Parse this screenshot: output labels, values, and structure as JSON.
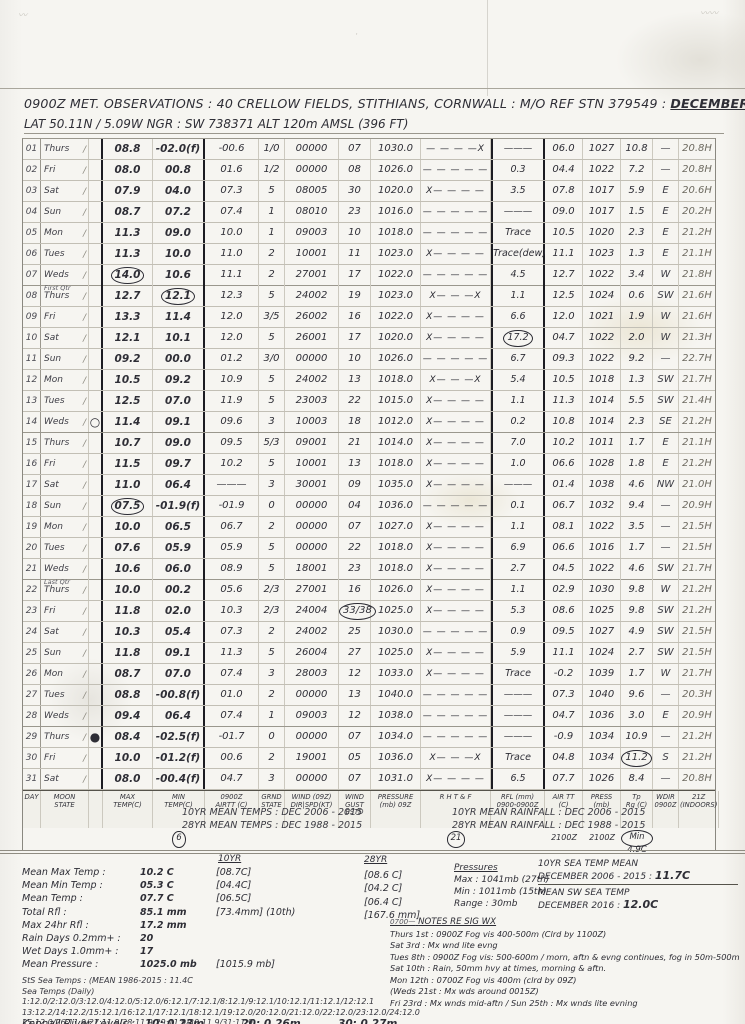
{
  "header": {
    "title_main": "0900Z  MET. OBSERVATIONS :  40 CRELLOW FIELDS, STITHIANS, CORNWALL :  M/O REF STN 379549 :",
    "title_period": "DECEMBER 2016",
    "subtitle": "LAT 50.11N / 5.09W    NGR : SW 738371    ALT 120m AMSL  (396 FT)"
  },
  "table": {
    "order": [
      "d",
      "wk",
      "moon",
      "mx",
      "mn",
      "a9",
      "g",
      "w",
      "gu",
      "p9",
      "rh",
      "rf",
      "a21",
      "p21",
      "tr",
      "wd",
      "ind"
    ],
    "footer_labels": {
      "d": "DAY",
      "wk": "MOON\nSTATE",
      "moon": "",
      "mx": "MAX\nTEMP(C)",
      "mn": "MIN\nTEMP(C)",
      "a9": "0900Z\nAIRTT (C)",
      "g": "GRND\nSTATE",
      "w": "WIND (09Z)\nDIR|SPD(KT)",
      "gu": "WIND\nGUST\nESTD",
      "p9": "PRESSURE\n(mb) 09Z",
      "rh": "R H T & F",
      "rf": "RFL (mm)\n0900-0900Z",
      "a21": "AIR TT\n(C)",
      "p21": "PRESS\n(mb)",
      "tr": "Tp\nRg (C)",
      "wd": "WDIR\n0900Z",
      "ind": "21Z\n(INDOORS)"
    },
    "footer_sub": {
      "mn": "6",
      "rh": "21",
      "a21": "2100Z",
      "p21": "2100Z",
      "tr": "Min 4.9C"
    },
    "rows": [
      {
        "d": "01",
        "wk": "Thurs",
        "note": "",
        "moon": "",
        "mx": "08.8",
        "mn": "-02.0(f)",
        "a9": "-00.6",
        "g": "1/0",
        "w": "00000",
        "gu": "07",
        "p9": "1030.0",
        "rh": "— — — —X",
        "rf": "———",
        "a21": "06.0",
        "p21": "1027",
        "tr": "10.8",
        "wd": "—",
        "ind": "20.8H",
        "circled": []
      },
      {
        "d": "02",
        "wk": "Fri",
        "note": "",
        "moon": "",
        "mx": "08.0",
        "mn": "00.8",
        "a9": "01.6",
        "g": "1/2",
        "w": "00000",
        "gu": "08",
        "p9": "1026.0",
        "rh": "— — — — —",
        "rf": "0.3",
        "a21": "04.4",
        "p21": "1022",
        "tr": "7.2",
        "wd": "—",
        "ind": "20.8H",
        "circled": []
      },
      {
        "d": "03",
        "wk": "Sat",
        "note": "",
        "moon": "",
        "mx": "07.9",
        "mn": "04.0",
        "a9": "07.3",
        "g": "5",
        "w": "08005",
        "gu": "30",
        "p9": "1020.0",
        "rh": "X— — — —",
        "rf": "3.5",
        "a21": "07.8",
        "p21": "1017",
        "tr": "5.9",
        "wd": "E",
        "ind": "20.6H",
        "circled": []
      },
      {
        "d": "04",
        "wk": "Sun",
        "note": "",
        "moon": "",
        "mx": "08.7",
        "mn": "07.2",
        "a9": "07.4",
        "g": "1",
        "w": "08010",
        "gu": "23",
        "p9": "1016.0",
        "rh": "— — — — —",
        "rf": "———",
        "a21": "09.0",
        "p21": "1017",
        "tr": "1.5",
        "wd": "E",
        "ind": "20.2H",
        "circled": []
      },
      {
        "d": "05",
        "wk": "Mon",
        "note": "",
        "moon": "",
        "mx": "11.3",
        "mn": "09.0",
        "a9": "10.0",
        "g": "1",
        "w": "09003",
        "gu": "10",
        "p9": "1018.0",
        "rh": "— — — — —",
        "rf": "Trace",
        "a21": "10.5",
        "p21": "1020",
        "tr": "2.3",
        "wd": "E",
        "ind": "21.2H",
        "circled": []
      },
      {
        "d": "06",
        "wk": "Tues",
        "note": "",
        "moon": "",
        "mx": "11.3",
        "mn": "10.0",
        "a9": "11.0",
        "g": "2",
        "w": "10001",
        "gu": "11",
        "p9": "1023.0",
        "rh": "X— — — —",
        "rf": "Trace(dew)",
        "a21": "11.1",
        "p21": "1023",
        "tr": "1.3",
        "wd": "E",
        "ind": "21.1H",
        "circled": []
      },
      {
        "d": "07",
        "wk": "Weds",
        "note": "First Qtr",
        "moon": "",
        "mx": "14.0",
        "mn": "10.6",
        "a9": "11.1",
        "g": "2",
        "w": "27001",
        "gu": "17",
        "p9": "1022.0",
        "rh": "— — — — —",
        "rf": "4.5",
        "a21": "12.7",
        "p21": "1022",
        "tr": "3.4",
        "wd": "W",
        "ind": "21.8H",
        "circled": [
          "mx"
        ]
      },
      {
        "d": "08",
        "wk": "Thurs",
        "note": "",
        "moon": "",
        "mx": "12.7",
        "mn": "12.1",
        "a9": "12.3",
        "g": "5",
        "w": "24002",
        "gu": "19",
        "p9": "1023.0",
        "rh": "X— — —X",
        "rf": "1.1",
        "a21": "12.5",
        "p21": "1024",
        "tr": "0.6",
        "wd": "SW",
        "ind": "21.6H",
        "circled": [
          "mn"
        ]
      },
      {
        "d": "09",
        "wk": "Fri",
        "note": "",
        "moon": "",
        "mx": "13.3",
        "mn": "11.4",
        "a9": "12.0",
        "g": "3/5",
        "w": "26002",
        "gu": "16",
        "p9": "1022.0",
        "rh": "X— — — —",
        "rf": "6.6",
        "a21": "12.0",
        "p21": "1021",
        "tr": "1.9",
        "wd": "W",
        "ind": "21.6H",
        "circled": []
      },
      {
        "d": "10",
        "wk": "Sat",
        "note": "",
        "moon": "",
        "mx": "12.1",
        "mn": "10.1",
        "a9": "12.0",
        "g": "5",
        "w": "26001",
        "gu": "17",
        "p9": "1020.0",
        "rh": "X— — — —",
        "rf": "17.2",
        "a21": "04.7",
        "p21": "1022",
        "tr": "2.0",
        "wd": "W",
        "ind": "21.3H",
        "circled": [
          "rf"
        ]
      },
      {
        "d": "11",
        "wk": "Sun",
        "note": "",
        "moon": "",
        "mx": "09.2",
        "mn": "00.0",
        "a9": "01.2",
        "g": "3/0",
        "w": "00000",
        "gu": "10",
        "p9": "1026.0",
        "rh": "— — — — —",
        "rf": "6.7",
        "a21": "09.3",
        "p21": "1022",
        "tr": "9.2",
        "wd": "—",
        "ind": "22.7H",
        "circled": []
      },
      {
        "d": "12",
        "wk": "Mon",
        "note": "",
        "moon": "",
        "mx": "10.5",
        "mn": "09.2",
        "a9": "10.9",
        "g": "5",
        "w": "24002",
        "gu": "13",
        "p9": "1018.0",
        "rh": "X— — —X",
        "rf": "5.4",
        "a21": "10.5",
        "p21": "1018",
        "tr": "1.3",
        "wd": "SW",
        "ind": "21.7H",
        "circled": []
      },
      {
        "d": "13",
        "wk": "Tues",
        "note": "",
        "moon": "",
        "mx": "12.5",
        "mn": "07.0",
        "a9": "11.9",
        "g": "5",
        "w": "23003",
        "gu": "22",
        "p9": "1015.0",
        "rh": "X— — — —",
        "rf": "1.1",
        "a21": "11.3",
        "p21": "1014",
        "tr": "5.5",
        "wd": "SW",
        "ind": "21.4H",
        "circled": []
      },
      {
        "d": "14",
        "wk": "Weds",
        "note": "",
        "moon": "○",
        "mx": "11.4",
        "mn": "09.1",
        "a9": "09.6",
        "g": "3",
        "w": "10003",
        "gu": "18",
        "p9": "1012.0",
        "rh": "X— — — —",
        "rf": "0.2",
        "a21": "10.8",
        "p21": "1014",
        "tr": "2.3",
        "wd": "SE",
        "ind": "21.2H",
        "circled": []
      },
      {
        "d": "15",
        "wk": "Thurs",
        "note": "",
        "moon": "",
        "mx": "10.7",
        "mn": "09.0",
        "a9": "09.5",
        "g": "5/3",
        "w": "09001",
        "gu": "21",
        "p9": "1014.0",
        "rh": "X— — — —",
        "rf": "7.0",
        "a21": "10.2",
        "p21": "1011",
        "tr": "1.7",
        "wd": "E",
        "ind": "21.1H",
        "circled": []
      },
      {
        "d": "16",
        "wk": "Fri",
        "note": "",
        "moon": "",
        "mx": "11.5",
        "mn": "09.7",
        "a9": "10.2",
        "g": "5",
        "w": "10001",
        "gu": "13",
        "p9": "1018.0",
        "rh": "X— — — —",
        "rf": "1.0",
        "a21": "06.6",
        "p21": "1028",
        "tr": "1.8",
        "wd": "E",
        "ind": "21.2H",
        "circled": []
      },
      {
        "d": "17",
        "wk": "Sat",
        "note": "",
        "moon": "",
        "mx": "11.0",
        "mn": "06.4",
        "a9": "———",
        "g": "3",
        "w": "30001",
        "gu": "09",
        "p9": "1035.0",
        "rh": "X— — — —",
        "rf": "———",
        "a21": "01.4",
        "p21": "1038",
        "tr": "4.6",
        "wd": "NW",
        "ind": "21.0H",
        "circled": []
      },
      {
        "d": "18",
        "wk": "Sun",
        "note": "",
        "moon": "",
        "mx": "07.5",
        "mn": "-01.9(f)",
        "a9": "-01.9",
        "g": "0",
        "w": "00000",
        "gu": "04",
        "p9": "1036.0",
        "rh": "— — — — —",
        "rf": "0.1",
        "a21": "06.7",
        "p21": "1032",
        "tr": "9.4",
        "wd": "—",
        "ind": "20.9H",
        "circled": [
          "mx"
        ]
      },
      {
        "d": "19",
        "wk": "Mon",
        "note": "",
        "moon": "",
        "mx": "10.0",
        "mn": "06.5",
        "a9": "06.7",
        "g": "2",
        "w": "00000",
        "gu": "07",
        "p9": "1027.0",
        "rh": "X— — — —",
        "rf": "1.1",
        "a21": "08.1",
        "p21": "1022",
        "tr": "3.5",
        "wd": "—",
        "ind": "21.5H",
        "circled": []
      },
      {
        "d": "20",
        "wk": "Tues",
        "note": "",
        "moon": "",
        "mx": "07.6",
        "mn": "05.9",
        "a9": "05.9",
        "g": "5",
        "w": "00000",
        "gu": "22",
        "p9": "1018.0",
        "rh": "X— — — —",
        "rf": "6.9",
        "a21": "06.6",
        "p21": "1016",
        "tr": "1.7",
        "wd": "—",
        "ind": "21.5H",
        "circled": []
      },
      {
        "d": "21",
        "wk": "Weds",
        "note": "Last Qtr",
        "moon": "",
        "mx": "10.6",
        "mn": "06.0",
        "a9": "08.9",
        "g": "5",
        "w": "18001",
        "gu": "23",
        "p9": "1018.0",
        "rh": "X— — — —",
        "rf": "2.7",
        "a21": "04.5",
        "p21": "1022",
        "tr": "4.6",
        "wd": "SW",
        "ind": "21.7H",
        "circled": []
      },
      {
        "d": "22",
        "wk": "Thurs",
        "note": "",
        "moon": "",
        "mx": "10.0",
        "mn": "00.2",
        "a9": "05.6",
        "g": "2/3",
        "w": "27001",
        "gu": "16",
        "p9": "1026.0",
        "rh": "X— — — —",
        "rf": "1.1",
        "a21": "02.9",
        "p21": "1030",
        "tr": "9.8",
        "wd": "W",
        "ind": "21.2H",
        "circled": []
      },
      {
        "d": "23",
        "wk": "Fri",
        "note": "",
        "moon": "",
        "mx": "11.8",
        "mn": "02.0",
        "a9": "10.3",
        "g": "2/3",
        "w": "24004",
        "gu": "33/38",
        "p9": "1025.0",
        "rh": "X— — — —",
        "rf": "5.3",
        "a21": "08.6",
        "p21": "1025",
        "tr": "9.8",
        "wd": "SW",
        "ind": "21.2H",
        "circled": [
          "gu"
        ]
      },
      {
        "d": "24",
        "wk": "Sat",
        "note": "",
        "moon": "",
        "mx": "10.3",
        "mn": "05.4",
        "a9": "07.3",
        "g": "2",
        "w": "24002",
        "gu": "25",
        "p9": "1030.0",
        "rh": "— — — — —",
        "rf": "0.9",
        "a21": "09.5",
        "p21": "1027",
        "tr": "4.9",
        "wd": "SW",
        "ind": "21.5H",
        "circled": []
      },
      {
        "d": "25",
        "wk": "Sun",
        "note": "",
        "moon": "",
        "mx": "11.8",
        "mn": "09.1",
        "a9": "11.3",
        "g": "5",
        "w": "26004",
        "gu": "27",
        "p9": "1025.0",
        "rh": "X— — — —",
        "rf": "5.9",
        "a21": "11.1",
        "p21": "1024",
        "tr": "2.7",
        "wd": "SW",
        "ind": "21.5H",
        "circled": []
      },
      {
        "d": "26",
        "wk": "Mon",
        "note": "",
        "moon": "",
        "mx": "08.7",
        "mn": "07.0",
        "a9": "07.4",
        "g": "3",
        "w": "28003",
        "gu": "12",
        "p9": "1033.0",
        "rh": "X— — — —",
        "rf": "Trace",
        "a21": "-0.2",
        "p21": "1039",
        "tr": "1.7",
        "wd": "W",
        "ind": "21.7H",
        "circled": []
      },
      {
        "d": "27",
        "wk": "Tues",
        "note": "",
        "moon": "",
        "mx": "08.8",
        "mn": "-00.8(f)",
        "a9": "01.0",
        "g": "2",
        "w": "00000",
        "gu": "13",
        "p9": "1040.0",
        "rh": "— — — — —",
        "rf": "———",
        "a21": "07.3",
        "p21": "1040",
        "tr": "9.6",
        "wd": "—",
        "ind": "20.3H",
        "circled": []
      },
      {
        "d": "28",
        "wk": "Weds",
        "note": "",
        "moon": "",
        "mx": "09.4",
        "mn": "06.4",
        "a9": "07.4",
        "g": "1",
        "w": "09003",
        "gu": "12",
        "p9": "1038.0",
        "rh": "— — — — —",
        "rf": "———",
        "a21": "04.7",
        "p21": "1036",
        "tr": "3.0",
        "wd": "E",
        "ind": "20.9H",
        "circled": []
      },
      {
        "d": "29",
        "wk": "Thurs",
        "note": "",
        "moon": "●",
        "mx": "08.4",
        "mn": "-02.5(f)",
        "a9": "-01.7",
        "g": "0",
        "w": "00000",
        "gu": "07",
        "p9": "1034.0",
        "rh": "— — — — —",
        "rf": "———",
        "a21": "-0.9",
        "p21": "1034",
        "tr": "10.9",
        "wd": "—",
        "ind": "21.2H",
        "circled": []
      },
      {
        "d": "30",
        "wk": "Fri",
        "note": "",
        "moon": "",
        "mx": "10.0",
        "mn": "-01.2(f)",
        "a9": "00.6",
        "g": "2",
        "w": "19001",
        "gu": "05",
        "p9": "1036.0",
        "rh": "X— — —X",
        "rf": "Trace",
        "a21": "04.8",
        "p21": "1034",
        "tr": "11.2",
        "wd": "S",
        "ind": "21.2H",
        "circled": [
          "tr"
        ]
      },
      {
        "d": "31",
        "wk": "Sat",
        "note": "",
        "moon": "",
        "mx": "08.0",
        "mn": "-00.4(f)",
        "a9": "04.7",
        "g": "3",
        "w": "00000",
        "gu": "07",
        "p9": "1031.0",
        "rh": "X— — — —",
        "rf": "6.5",
        "a21": "07.7",
        "p21": "1026",
        "tr": "8.4",
        "wd": "—",
        "ind": "20.8H",
        "circled": []
      }
    ]
  },
  "refs": {
    "left": "10YR MEAN TEMPS :   DEC 2006 - 2015\n28YR MEAN TEMPS :   DEC 1988 - 2015",
    "right": "10YR MEAN RAINFALL :  DEC 2006 - 2015\n28YR MEAN RAINFALL :  DEC 1988 - 2015"
  },
  "summary": {
    "hdr10": "10YR",
    "stats": [
      {
        "label": "Mean Max Temp :",
        "value": "10.2 C",
        "b10": "[08.7C]"
      },
      {
        "label": "Mean Min Temp :",
        "value": "05.3 C",
        "b10": "[04.4C]"
      },
      {
        "label": "Mean Temp :",
        "value": "07.7 C",
        "b10": "[06.5C]"
      },
      {
        "label": "Total Rfl :",
        "value": "85.1 mm",
        "b10": "[73.4mm] (10th)"
      },
      {
        "label": "Max 24hr Rfl :",
        "value": "17.2 mm",
        "b10": ""
      },
      {
        "label": "Rain Days 0.2mm+ :",
        "value": "20",
        "b10": ""
      },
      {
        "label": "Wet Days 1.0mm+ :",
        "value": "17",
        "b10": ""
      },
      {
        "label": "Mean Pressure :",
        "value": "1025.0 mb",
        "b10": "[1015.9 mb]"
      }
    ],
    "col28": {
      "header": "28YR",
      "values": [
        "[08.6 C]",
        "[04.2 C]",
        "[06.4 C]",
        "[167.6 mm]"
      ]
    },
    "pressures": {
      "header": "Pressures",
      "lines": [
        "Max :  1041mb (27th)",
        "Min :  1011mb (15th)",
        "Range :  30mb"
      ]
    },
    "sea_lines": [
      "StS Sea Temps : (MEAN 1986-2015 : 11.4C",
      "Sea Temps (Daily) 1:12.0/2:12.0/3:12.0/4:12.0/5:12.0/6:12.1/7:12.1/8:12.1/9:12.1/10:12.1/11:12.1/12:12.1",
      "13:12.2/14:12.2/15:12.1/16:12.1/17:12.1/18:12.1/19:12.0/20:12.0/21:12.0/22:12.0/23:12.0/24:12.0",
      "25:12.0/26:11.9/27:11.9/28:11.9/29:11.9/30:11.9/31:11.9"
    ],
    "kennall": {
      "label": "Kennall River Levels :",
      "e1": "10:  0.23m",
      "e2": "20:  0.26m",
      "e3": "30:  0.27m"
    }
  },
  "sea_block": {
    "l1": "10YR SEA TEMP MEAN",
    "l2": "DECEMBER 2006 - 2015 :",
    "v2": "11.7C",
    "l3": "MEAN SW SEA TEMP",
    "l4": "DECEMBER 2016 :",
    "v4": "12.0C"
  },
  "notes": {
    "pre": "0700—",
    "header": "NOTES RE SIG WX",
    "lines": [
      "Thurs 1st : 0900Z Fog vis 400-500m (Clrd by 1100Z)",
      "Sat 3rd : Mx wnd lite evng",
      "Tues 8th : 0900Z Fog vis: 500-600m / morn, aftn & evng continues, fog in 50m-500m",
      "Sat 10th : Rain, 50mm hvy at times, morning & aftn.",
      "Mon 12th : 0700Z Fog vis 400m (clrd by 09Z)",
      "(Weds 21st : Mx wds around 0015Z)",
      "Fri 23rd : Mx wnds mid-aftn / Sun 25th : Mx wnds lite evning"
    ]
  }
}
